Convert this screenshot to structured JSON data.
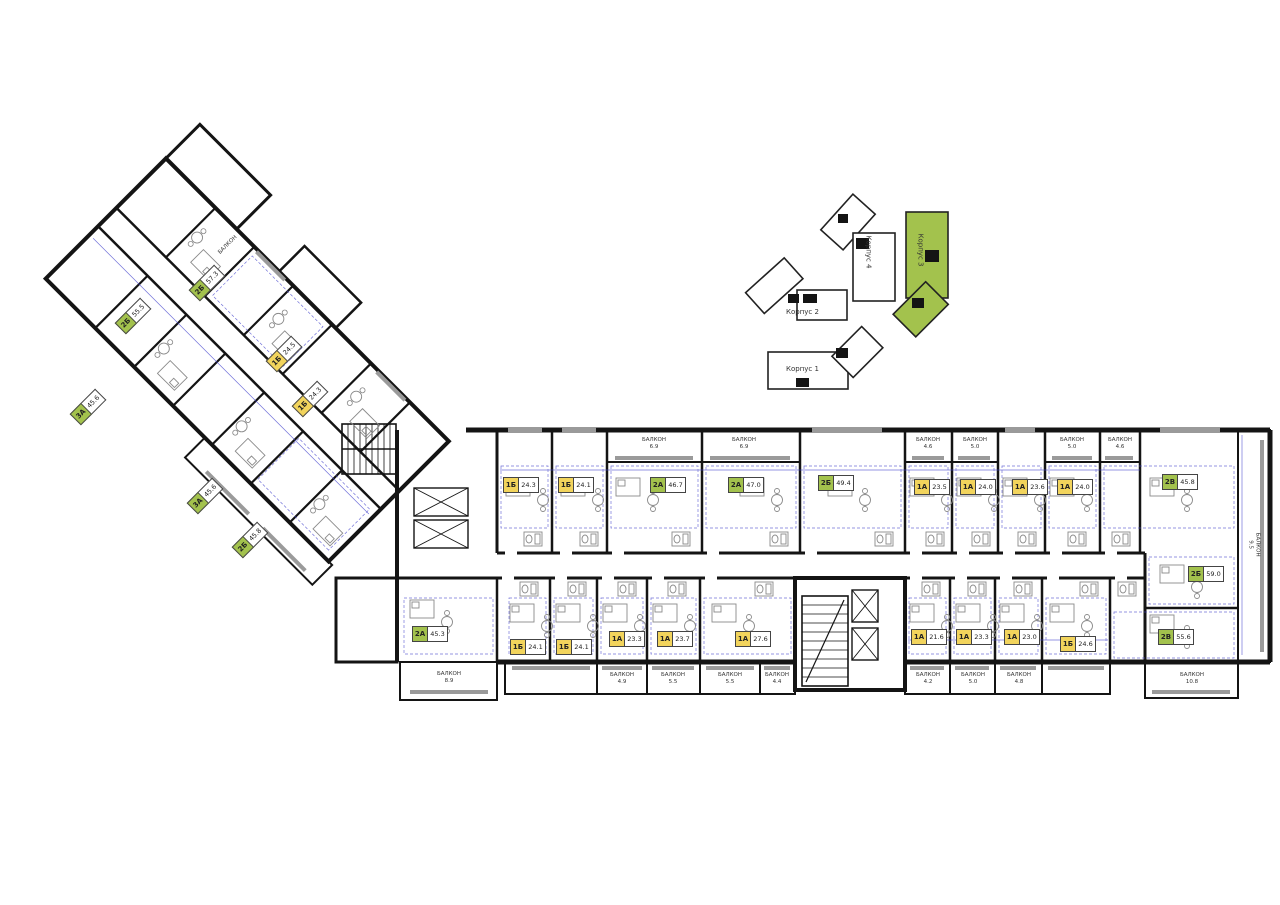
{
  "site_plan": {
    "buildings": [
      {
        "name": "Корпус 2",
        "highlighted": false
      },
      {
        "name": "Корпус 4",
        "highlighted": false
      },
      {
        "name": "Корпус 3",
        "highlighted": true
      },
      {
        "name": "Корпус 1",
        "highlighted": false
      }
    ],
    "highlight_color": "#a3c24d"
  },
  "units": {
    "top": [
      {
        "type": "1Б",
        "area": "24.3"
      },
      {
        "type": "1Б",
        "area": "24.1"
      },
      {
        "type": "2А",
        "area": "46.7"
      },
      {
        "type": "2А",
        "area": "47.0"
      },
      {
        "type": "2Б",
        "area": "49.4"
      },
      {
        "type": "1А",
        "area": "23.5"
      },
      {
        "type": "1А",
        "area": "24.0"
      },
      {
        "type": "1А",
        "area": "23.6"
      },
      {
        "type": "1А",
        "area": "24.0"
      },
      {
        "type": "2В",
        "area": "45.8"
      }
    ],
    "bottom": [
      {
        "type": "2А",
        "area": "45.3"
      },
      {
        "type": "1Б",
        "area": "24.1"
      },
      {
        "type": "1Б",
        "area": "24.1"
      },
      {
        "type": "1А",
        "area": "23.3"
      },
      {
        "type": "1А",
        "area": "23.7"
      },
      {
        "type": "1А",
        "area": "27.6"
      },
      {
        "type": "1А",
        "area": "21.6"
      },
      {
        "type": "1А",
        "area": "23.3"
      },
      {
        "type": "1А",
        "area": "23.0"
      },
      {
        "type": "1Б",
        "area": "24.6"
      }
    ],
    "right_end": [
      {
        "type": "2Б",
        "area": "59.0"
      },
      {
        "type": "2В",
        "area": "55.6"
      }
    ],
    "left_wing": [
      {
        "type": "2Б",
        "area": "57.3"
      },
      {
        "type": "2Б",
        "area": "55.5"
      },
      {
        "type": "3А",
        "area": "45.6"
      },
      {
        "type": "1Б",
        "area": "24.5"
      },
      {
        "type": "1Б",
        "area": "24.3"
      },
      {
        "type": "3А",
        "area": "45.6"
      },
      {
        "type": "2Б",
        "area": "45.8"
      }
    ]
  },
  "balconies": {
    "top": [
      {
        "label": "БАЛКОН",
        "area": "6.9"
      },
      {
        "label": "БАЛКОН",
        "area": "6.9"
      },
      {
        "label": "БАЛКОН",
        "area": "4.6"
      },
      {
        "label": "БАЛКОН",
        "area": "5.0"
      },
      {
        "label": "БАЛКОН",
        "area": "5.0"
      },
      {
        "label": "БАЛКОН",
        "area": "4.6"
      }
    ],
    "bottom": [
      {
        "label": "БАЛКОН",
        "area": "8.9"
      },
      {
        "label": "БАЛКОН",
        "area": "4.9"
      },
      {
        "label": "БАЛКОН",
        "area": "5.5"
      },
      {
        "label": "БАЛКОН",
        "area": "5.5"
      },
      {
        "label": "БАЛКОН",
        "area": "4.4"
      },
      {
        "label": "БАЛКОН",
        "area": "4.2"
      },
      {
        "label": "БАЛКОН",
        "area": "5.0"
      },
      {
        "label": "БАЛКОН",
        "area": "4.8"
      },
      {
        "label": "БАЛКОН",
        "area": "10.8"
      }
    ],
    "right_vertical": {
      "label": "БАЛКОН",
      "area": "9.5"
    },
    "left_wing": {
      "label": "БАЛКОН",
      "area": ""
    }
  },
  "colors": {
    "one_room_badge": "#f2d45c",
    "multi_room_badge": "#a3c24d",
    "walls": "#141414",
    "dimension_lines": "#4444cc",
    "site_highlight": "#a3c24d"
  }
}
